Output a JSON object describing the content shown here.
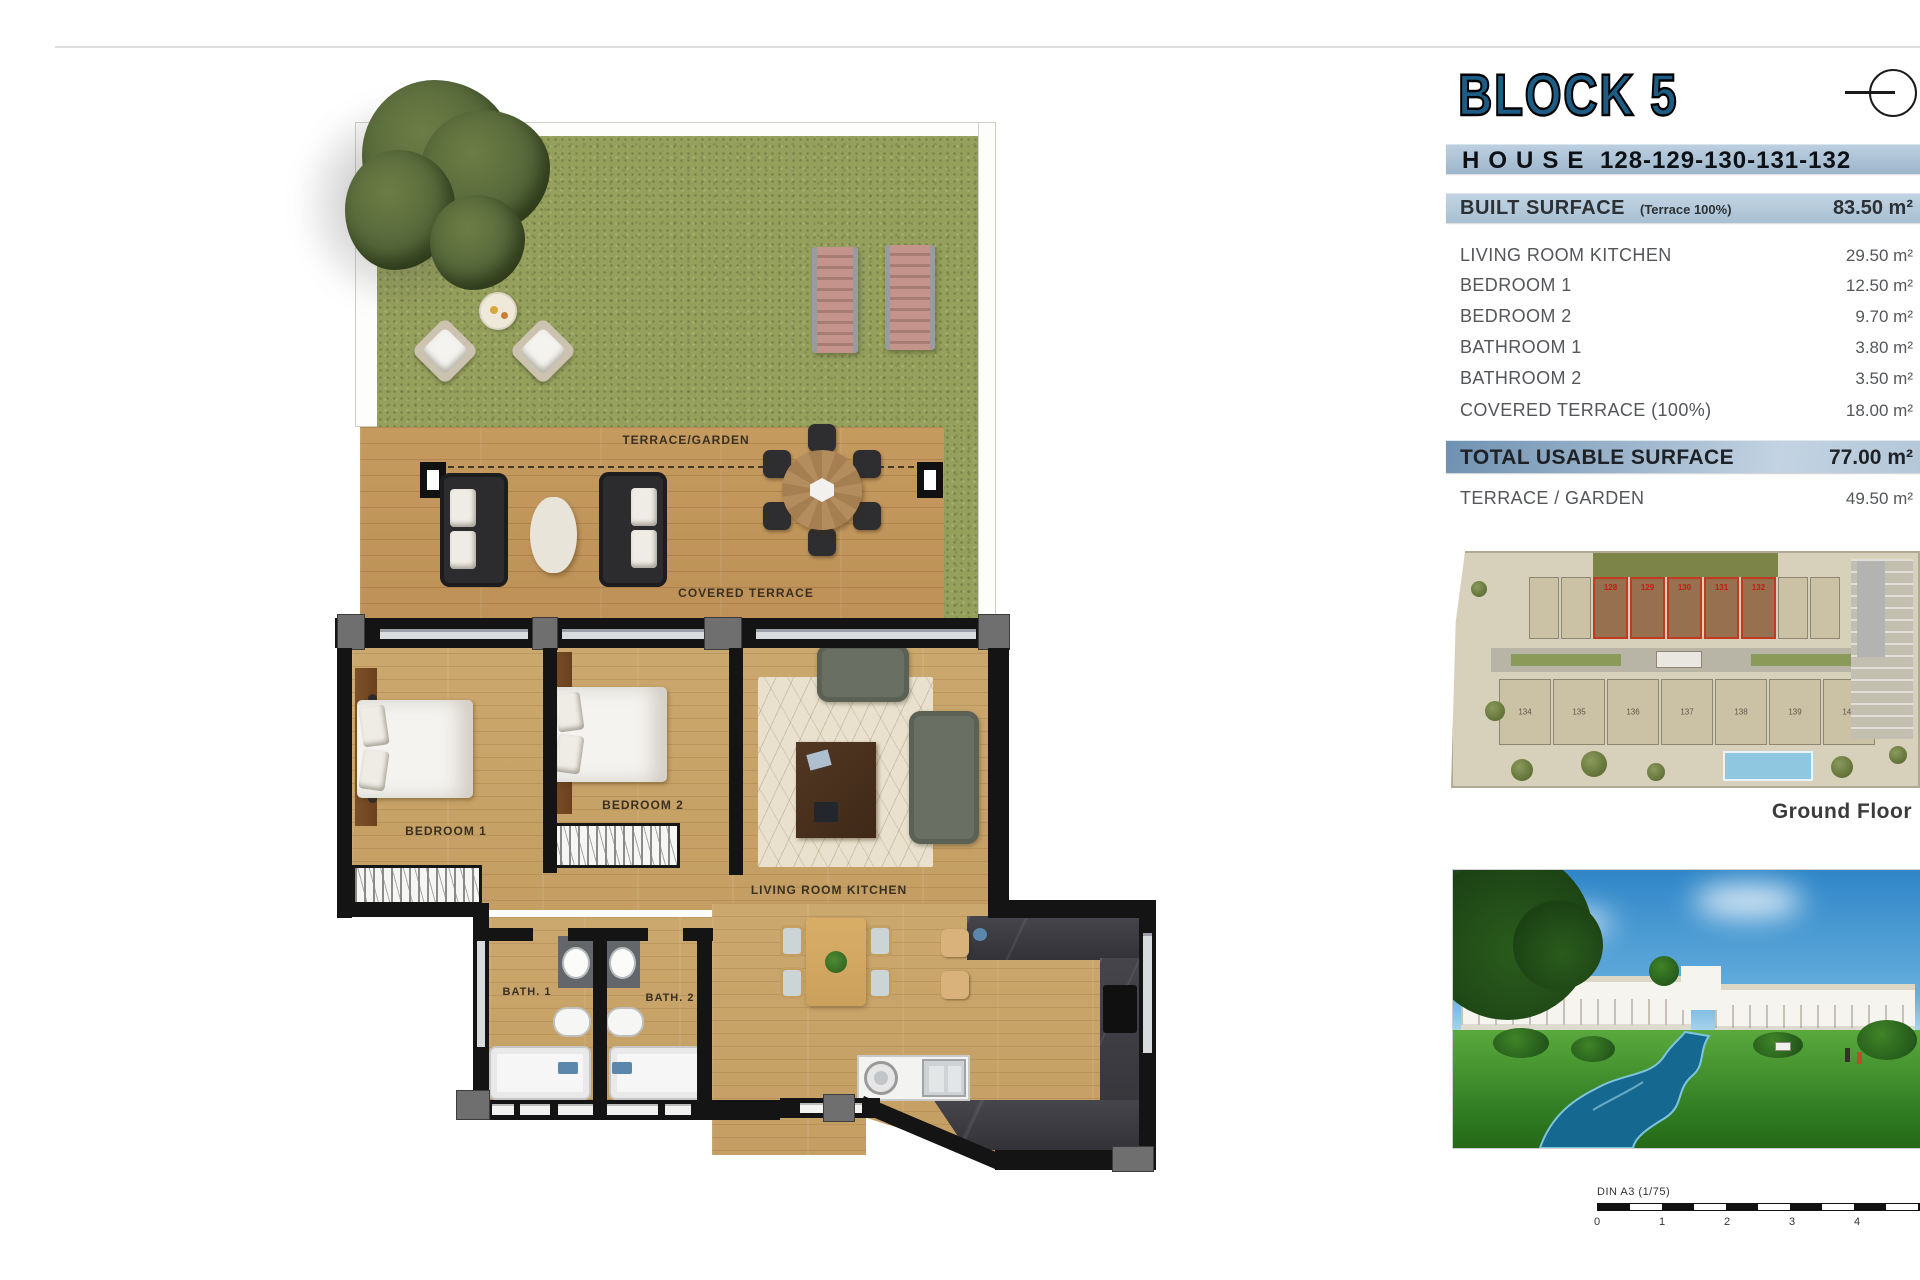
{
  "info_panel": {
    "block_title": "BLOCK 5",
    "house_label": "HOUSE",
    "house_numbers": "128-129-130-131-132",
    "built_surface_label": "BUILT SURFACE",
    "built_surface_note": "(Terrace 100%)",
    "built_surface_value": "83.50 m²",
    "rows": [
      {
        "label": "LIVING ROOM KITCHEN",
        "value": "29.50 m²"
      },
      {
        "label": "BEDROOM 1",
        "value": "12.50 m²"
      },
      {
        "label": "BEDROOM 2",
        "value": "9.70 m²"
      },
      {
        "label": "BATHROOM 1",
        "value": "3.80 m²"
      },
      {
        "label": "BATHROOM 2",
        "value": "3.50 m²"
      },
      {
        "label": "COVERED TERRACE (100%)",
        "value": "18.00 m²"
      }
    ],
    "total_label": "TOTAL USABLE SURFACE",
    "total_value": "77.00 m²",
    "terrace_row_label": "TERRACE / GARDEN",
    "terrace_row_value": "49.50 m²",
    "ground_floor_caption": "Ground Floor"
  },
  "floor_plan": {
    "labels": {
      "terrace_garden": "TERRACE/GARDEN",
      "covered_terrace": "COVERED TERRACE",
      "bedroom1": "BEDROOM 1",
      "bedroom2": "BEDROOM 2",
      "living_room_kitchen": "LIVING ROOM KITCHEN",
      "bath1": "BATH. 1",
      "bath2": "BATH. 2"
    }
  },
  "site_plan": {
    "highlighted_units": [
      "128",
      "129",
      "130",
      "131",
      "132"
    ],
    "lower_units": [
      "134",
      "135",
      "136",
      "137",
      "138",
      "139",
      "140"
    ]
  },
  "scale_bar": {
    "label": "DIN A3 (1/75)",
    "ticks": [
      "0",
      "1",
      "2",
      "3",
      "4"
    ]
  },
  "colors": {
    "band_blue": "#a8c0d3",
    "total_band_blue": "#6f91b1",
    "block_title_blue": "#1d5d85",
    "grass_green": "#96a05d",
    "deck_wood": "#c59a5f",
    "floor_wood": "#cba86e",
    "wall_black": "#141414",
    "highlight_red": "#c23a22",
    "pool_blue": "#8fc6e0",
    "sky_blue": "#2f86c8"
  }
}
